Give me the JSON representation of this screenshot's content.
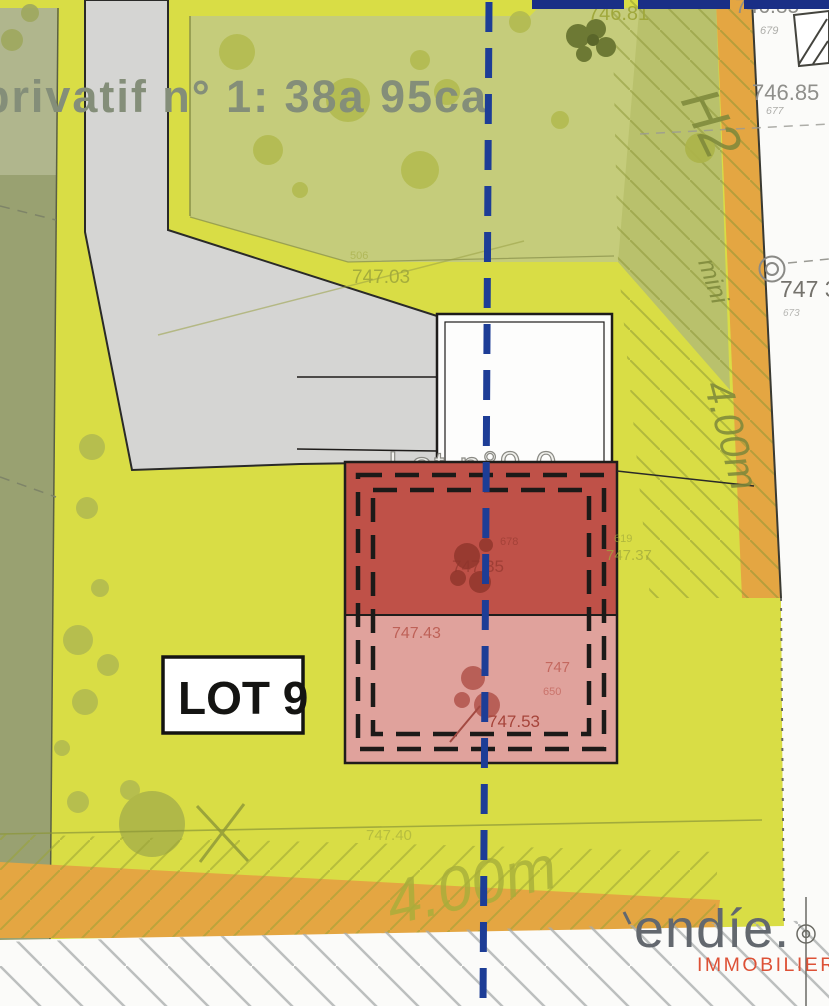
{
  "plan": {
    "area_label": "privatif n° 1: 38a 95ca",
    "lot_box_label": "LOT 9",
    "building_label": "Lot n°9.0",
    "zone_labels": {
      "h2": "H2",
      "mini": "mini",
      "setback_right": "4.00m",
      "setback_bottom": "4.00m"
    },
    "elevations": {
      "e746_81": "746.81",
      "e746_85_top": "746.85",
      "p679": "679",
      "e746_85": "746.85",
      "p677": "677",
      "e747_03": "747.03",
      "p506": "506",
      "e747_3": "747 3",
      "p673": "673",
      "e747_37": "747.37",
      "p619": "619",
      "e747_35": "747.35",
      "p678": "678",
      "e747_43": "747.43",
      "e747_r": "747",
      "p650": "650",
      "e747_53": "747.53",
      "e747_40": "747.40"
    },
    "colors": {
      "yellow": "#d9dd45",
      "green_zone": "#c5cc7b",
      "olive_left": "#99a171",
      "sage_top_left": "#b0b68d",
      "hatch_zone": "#b9c16c",
      "orange_strip": "#e4a642",
      "path_grey": "#d5d5d3",
      "paper_white": "#fbfbf9",
      "roof_dark_red": "#bf5148",
      "roof_light_pink": "#e0a29c",
      "axis_blue": "#1d3d96",
      "navy_bar": "#1a2f86",
      "area_text_grey": "#848e79",
      "elevation_olive": "#a0a83c",
      "logo_grey": "#63686e",
      "logo_orange": "#dd5136"
    },
    "logo": {
      "brand": "endíe.",
      "tagline": "IMMOBILIER"
    }
  }
}
